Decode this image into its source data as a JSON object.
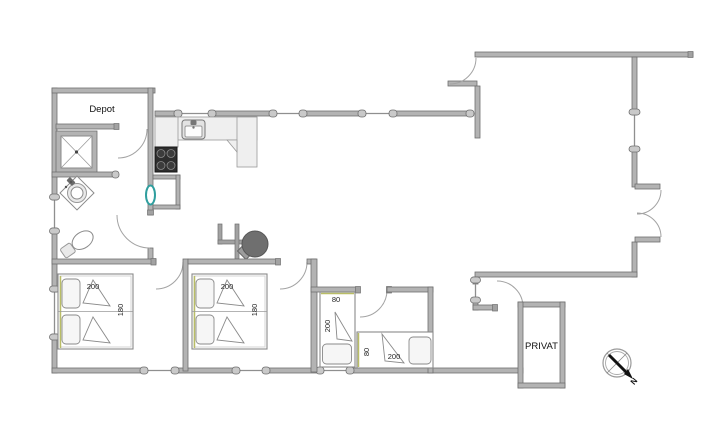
{
  "floorplan": {
    "labels": {
      "depot": "Depot",
      "privat": "PRIVAT",
      "north": "N",
      "bed1_length": "200",
      "bed1_width": "180",
      "bed2_length": "200",
      "bed2_width": "180",
      "bed3_width": "80",
      "bed3_length": "200",
      "bed4_width": "80",
      "bed4_length": "200"
    },
    "colors": {
      "wall": "#b3b3b3",
      "wall_edge": "#6f6f6f",
      "counter": "#efefef",
      "stove": "#2e2e2e",
      "wood_stove": "#6f6f6f",
      "accent_teal": "#2f9e9e",
      "accent_olive": "#b9bd66",
      "background": "#ffffff"
    }
  }
}
